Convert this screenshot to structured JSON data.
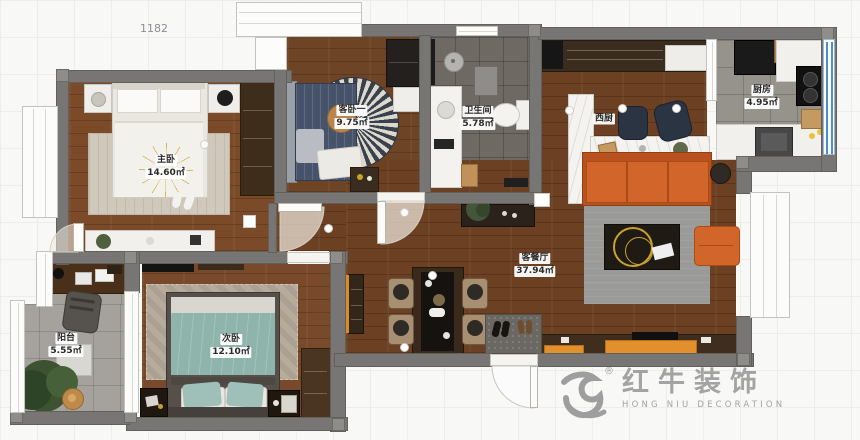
{
  "meta": {
    "top_dimension": "1182"
  },
  "rooms": {
    "master": {
      "name": "主卧",
      "area": "14.60㎡"
    },
    "guest": {
      "name": "客卧一",
      "area": "9.75㎡"
    },
    "bathroom": {
      "name": "卫生间",
      "area": "5.78㎡"
    },
    "west_kitchen": {
      "name": "西厨"
    },
    "kitchen": {
      "name": "厨房",
      "area": "4.95㎡"
    },
    "living_dining": {
      "name": "客餐厅",
      "area": "37.94㎡"
    },
    "second": {
      "name": "次卧",
      "area": "12.10㎡"
    },
    "balcony": {
      "name": "阳台",
      "area": "5.55㎡"
    }
  },
  "logo": {
    "brand": "红牛装饰",
    "registered": "®",
    "subtitle": "HONG NIU DECORATION"
  },
  "colors": {
    "accent_orange": "#d2652a",
    "wall_gray": "#787674",
    "window_blue": "#4a8fd4",
    "gold": "#c9a22e"
  }
}
